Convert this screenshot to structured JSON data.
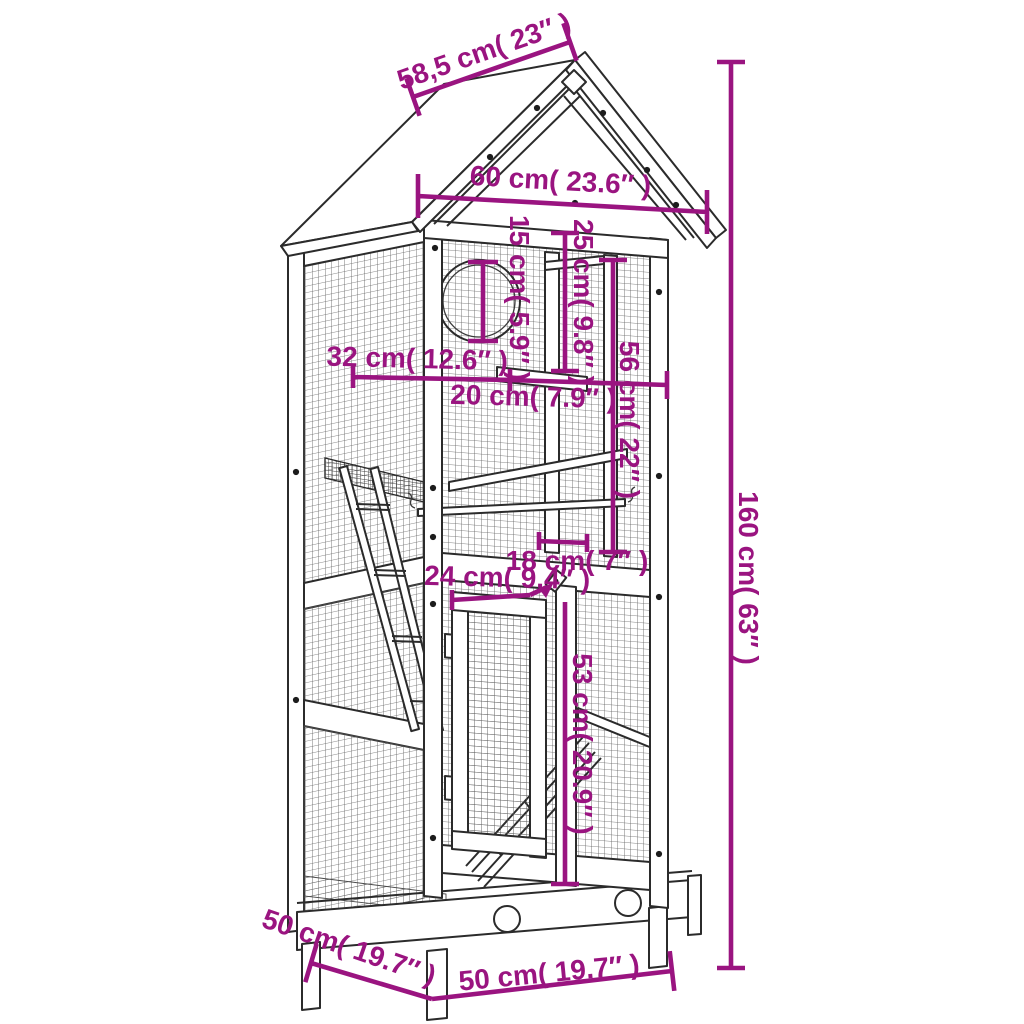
{
  "figure": {
    "subject": "Outdoor wooden bird cage aviary with gable roof — technical line drawing with dimensions",
    "style": "black outline drawing on white with magenta dimension annotations",
    "accent_color": "#9a1480",
    "line_color": "#2b2b2b",
    "background_color": "#ffffff"
  },
  "dims": {
    "roof_slope": {
      "label": "58,5 cm( 23″ )",
      "value_cm": 58.5,
      "value_in": 23,
      "measures": "roof slope width"
    },
    "roof_width": {
      "label": "60 cm( 23.6″ )",
      "value_cm": 60,
      "value_in": 23.6,
      "measures": "roof overall width"
    },
    "hole": {
      "label": "15 cm( 5.9″ )",
      "value_cm": 15,
      "value_in": 5.9,
      "measures": "entry hole diameter"
    },
    "nest": {
      "label": "25 cm( 9.8″ )",
      "value_cm": 25,
      "value_in": 9.8,
      "measures": "nest compartment height"
    },
    "upper": {
      "label": "56 cm( 22″ )",
      "value_cm": 56,
      "value_in": 22,
      "measures": "upper section height"
    },
    "shelf": {
      "label": "32 cm( 12.6″ )",
      "value_cm": 32,
      "value_in": 12.6,
      "measures": "shelf width"
    },
    "opening": {
      "label": "20 cm( 7.9″ )",
      "value_cm": 20,
      "value_in": 7.9,
      "measures": "opening width"
    },
    "hatch": {
      "label": "18 cm( 7″ )",
      "value_cm": 18,
      "value_in": 7,
      "measures": "hatch gap width"
    },
    "door_w": {
      "label": "24 cm( 9.4″ )",
      "value_cm": 24,
      "value_in": 9.4,
      "measures": "door width"
    },
    "door_h": {
      "label": "53 cm( 20.9″ )",
      "value_cm": 53,
      "value_in": 20.9,
      "measures": "door height"
    },
    "total_height": {
      "label": "160 cm( 63″ )",
      "value_cm": 160,
      "value_in": 63,
      "measures": "total height"
    },
    "base_depth": {
      "label": "50 cm( 19.7″ )",
      "value_cm": 50,
      "value_in": 19.7,
      "measures": "base depth"
    },
    "base_width": {
      "label": "50 cm( 19.7″ )",
      "value_cm": 50,
      "value_in": 19.7,
      "measures": "base width"
    }
  }
}
